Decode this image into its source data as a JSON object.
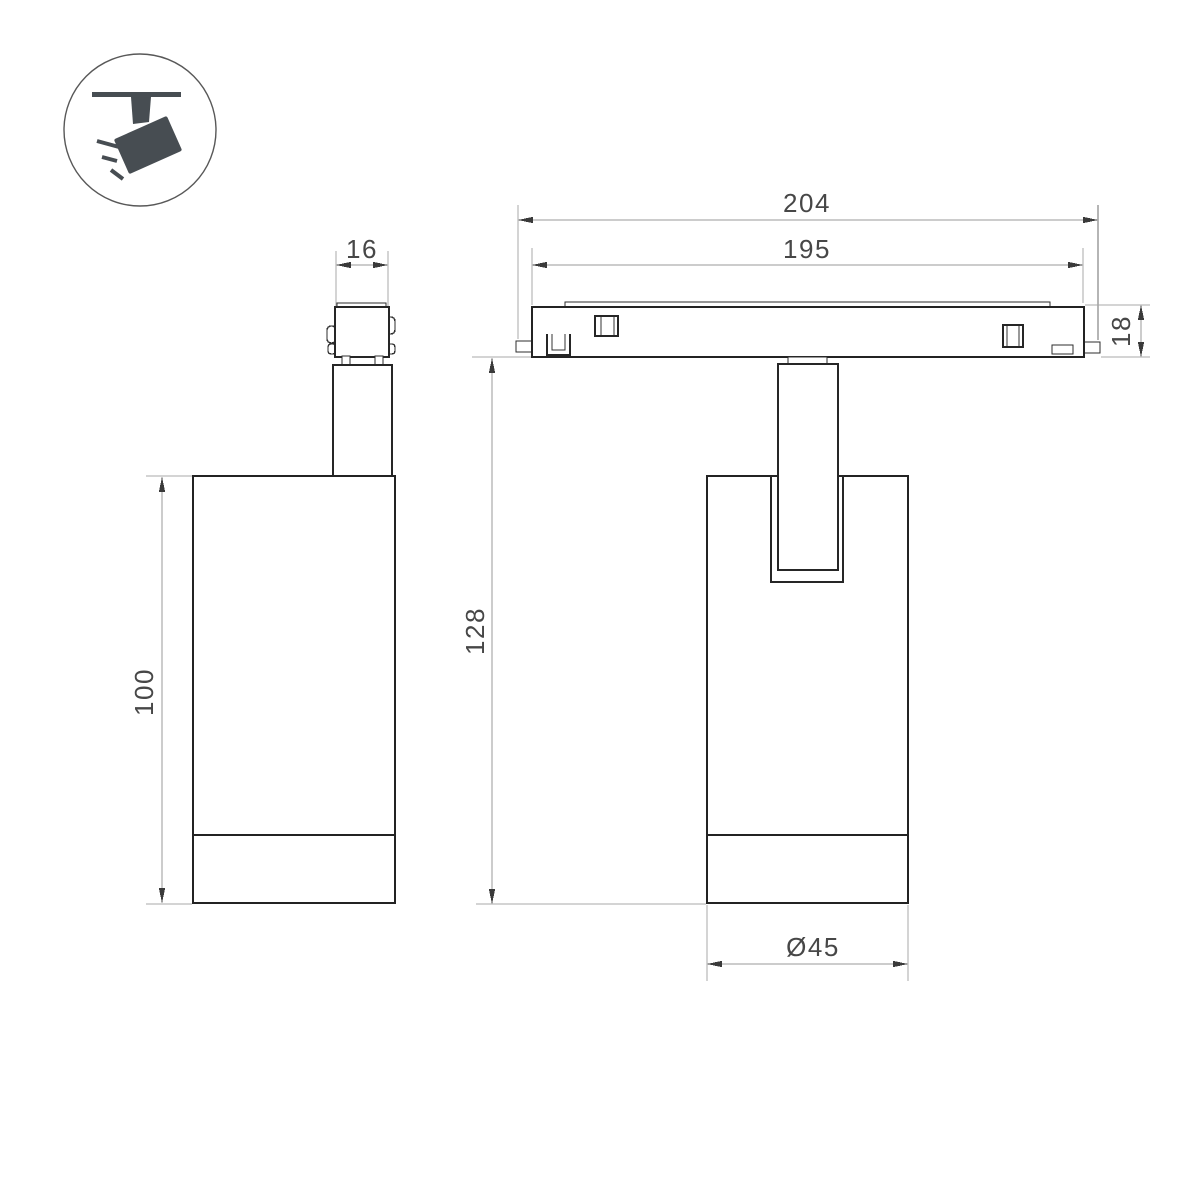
{
  "icon": {
    "name": "ceiling-track-spotlight",
    "color": "#474d52"
  },
  "dimensions": {
    "adapter_width": "16",
    "track_overall_length": "204",
    "track_visible_length": "195",
    "track_height": "18",
    "suspension_height": "128",
    "body_height": "100",
    "body_diameter": "Ø45"
  },
  "colors": {
    "outline": "#232323",
    "dimension_line": "#9a9a9a",
    "dimension_text": "#474747"
  }
}
